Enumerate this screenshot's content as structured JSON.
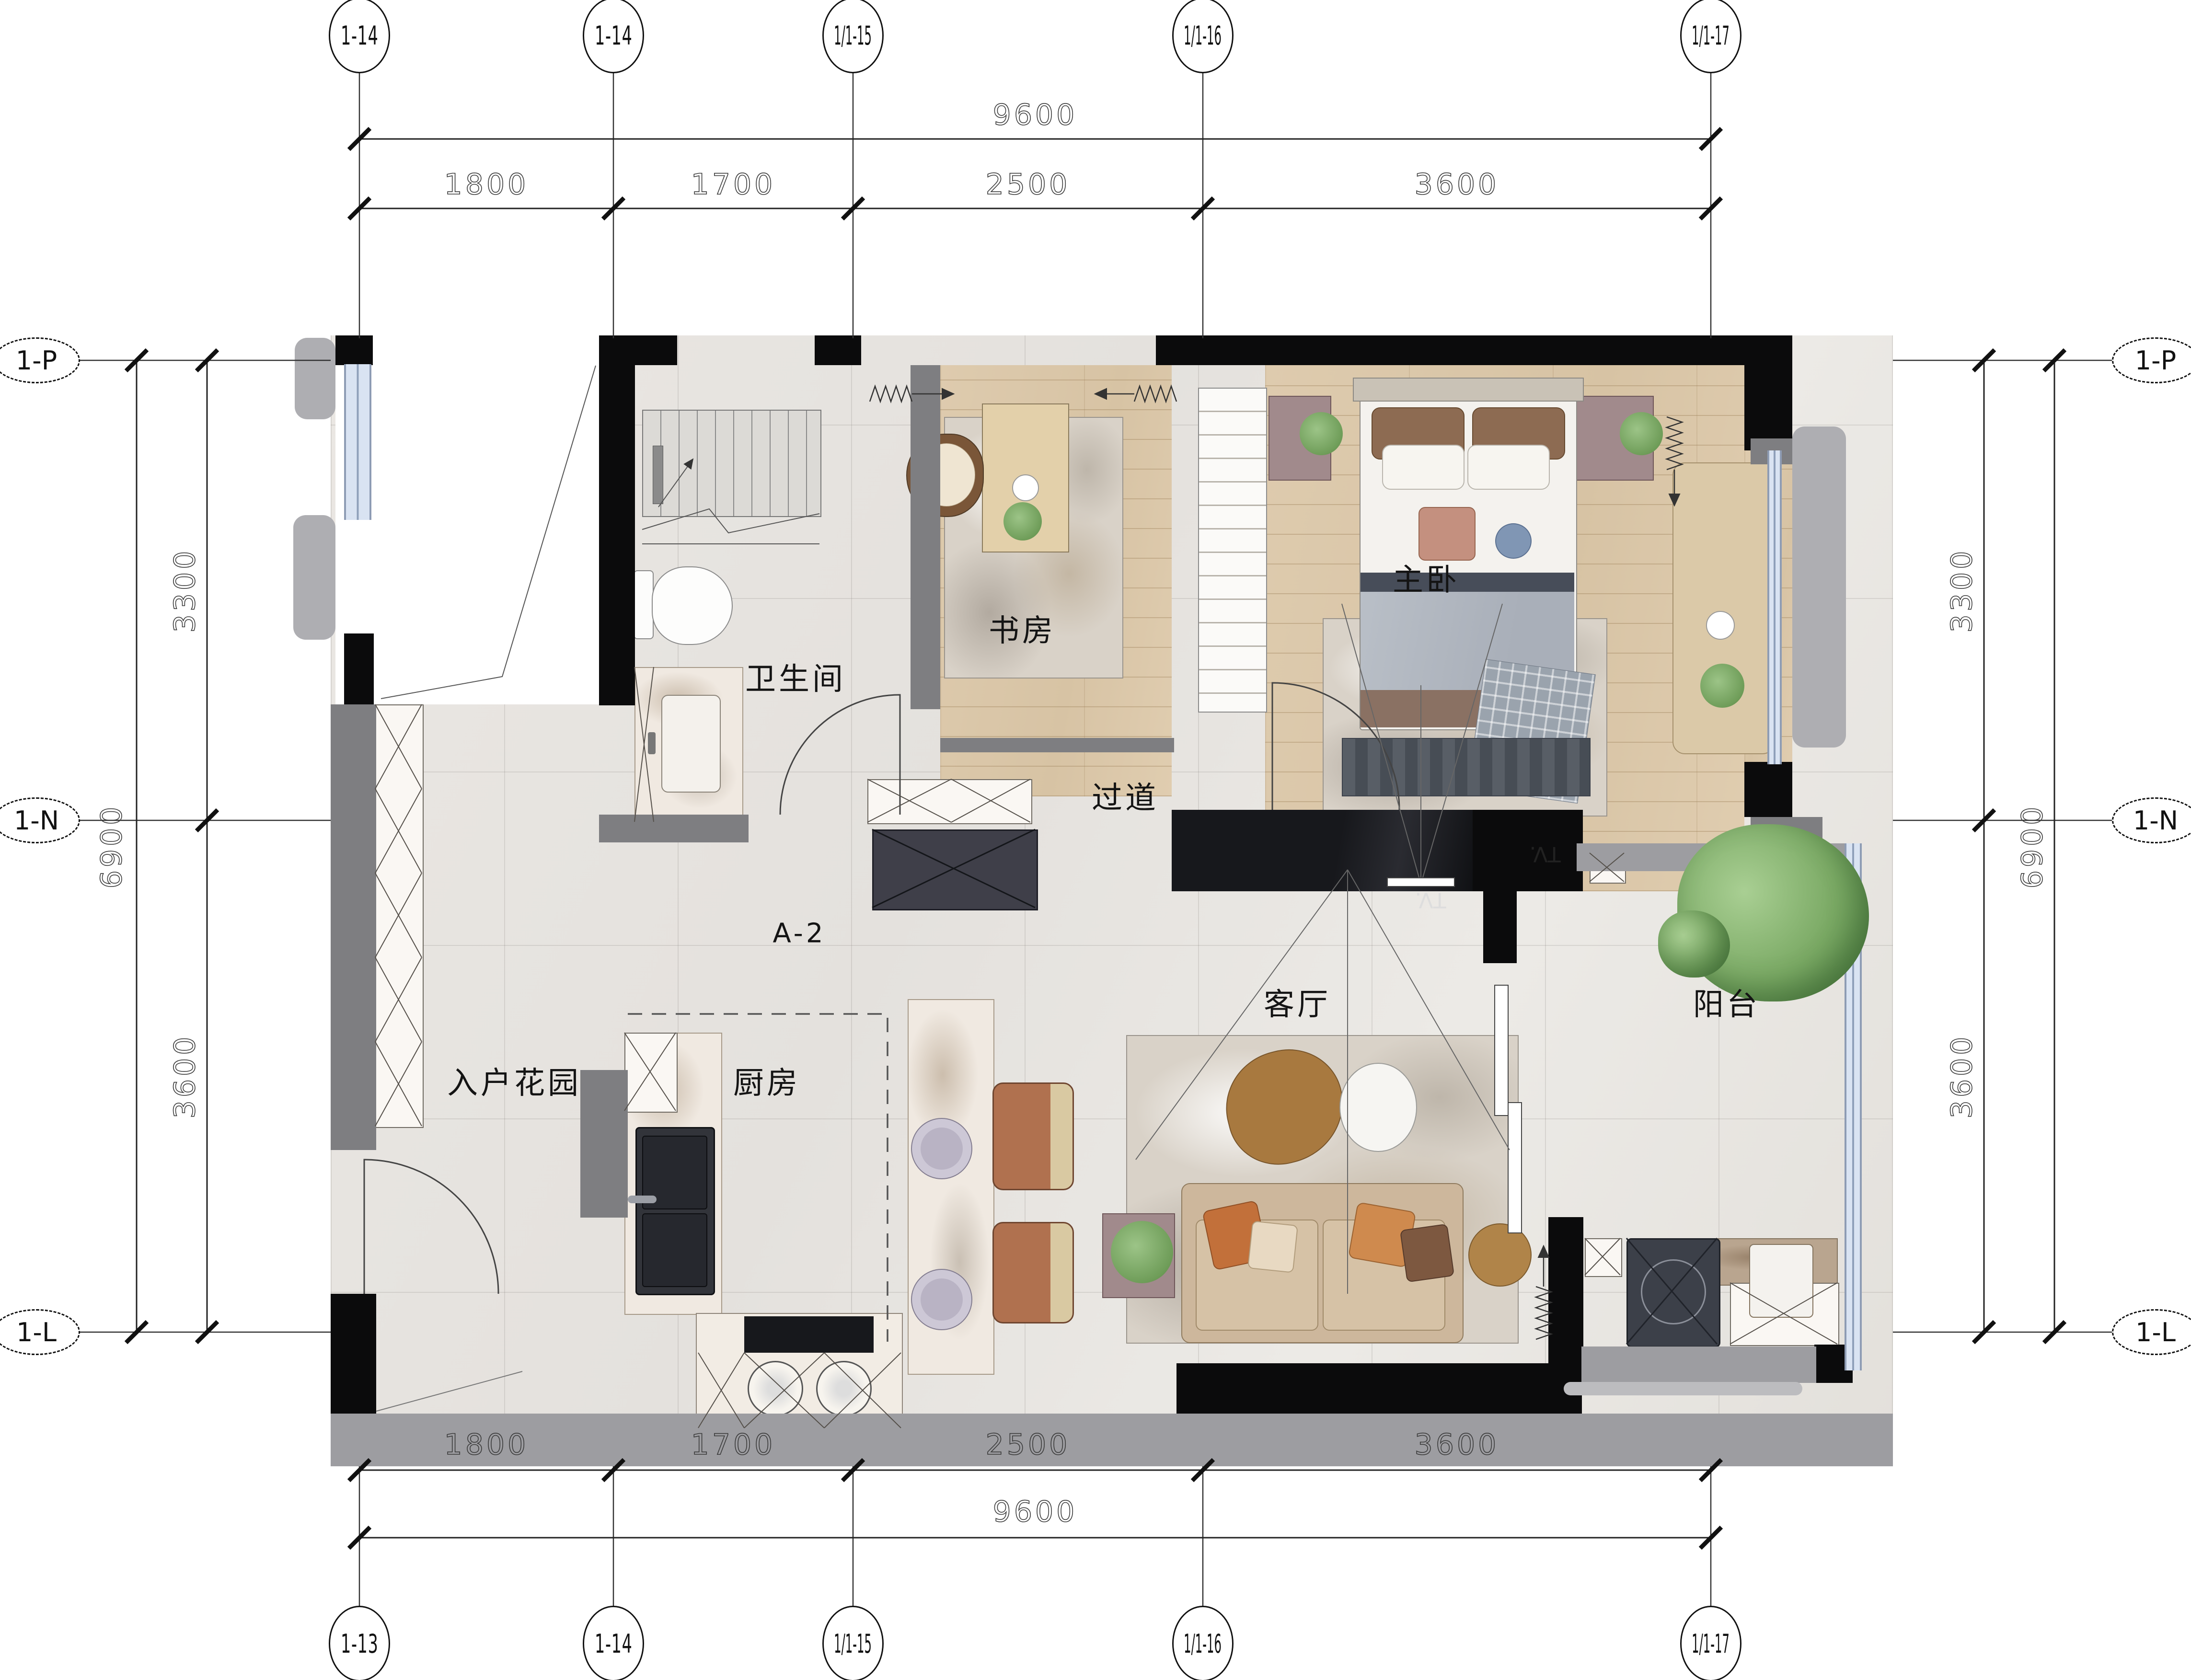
{
  "axes": {
    "top": [
      {
        "label": "1-14"
      },
      {
        "label": "1-14"
      },
      {
        "label": "1/1-15"
      },
      {
        "label": "1/1-16"
      },
      {
        "label": "1/1-17"
      }
    ],
    "bottom": [
      {
        "label": "1-13"
      },
      {
        "label": "1-14"
      },
      {
        "label": "1/1-15"
      },
      {
        "label": "1/1-16"
      },
      {
        "label": "1/1-17"
      }
    ],
    "left": [
      {
        "label": "1-P"
      },
      {
        "label": "1-N"
      },
      {
        "label": "1-L"
      }
    ],
    "right": [
      {
        "label": "1-P"
      },
      {
        "label": "1-N"
      },
      {
        "label": "1-L"
      }
    ]
  },
  "dimensions": {
    "top_overall": "9600",
    "top_segments": [
      "1800",
      "1700",
      "2500",
      "3600"
    ],
    "bottom_overall": "9600",
    "bottom_segments": [
      "1800",
      "1700",
      "2500",
      "3600"
    ],
    "left_overall": "6900",
    "left_segments": [
      "3300",
      "3600"
    ],
    "right_overall": "6900",
    "right_segments": [
      "3300",
      "3600"
    ]
  },
  "rooms": {
    "study": "书房",
    "bathroom": "卫生间",
    "hallway": "过道",
    "master_bedroom": "主卧",
    "living_room": "客厅",
    "balcony": "阳台",
    "entry_garden": "入户花园",
    "kitchen": "厨房"
  },
  "labels": {
    "unit": "A-2",
    "tv": "TV."
  },
  "colors": {
    "wall": "#0b0b0c",
    "partition": "#7e7e81",
    "window_glass": "#d9e3f2",
    "wood_floor": "#dac6a8",
    "tile_floor": "#e8e5e1",
    "accent_wood": "#a8793f"
  }
}
